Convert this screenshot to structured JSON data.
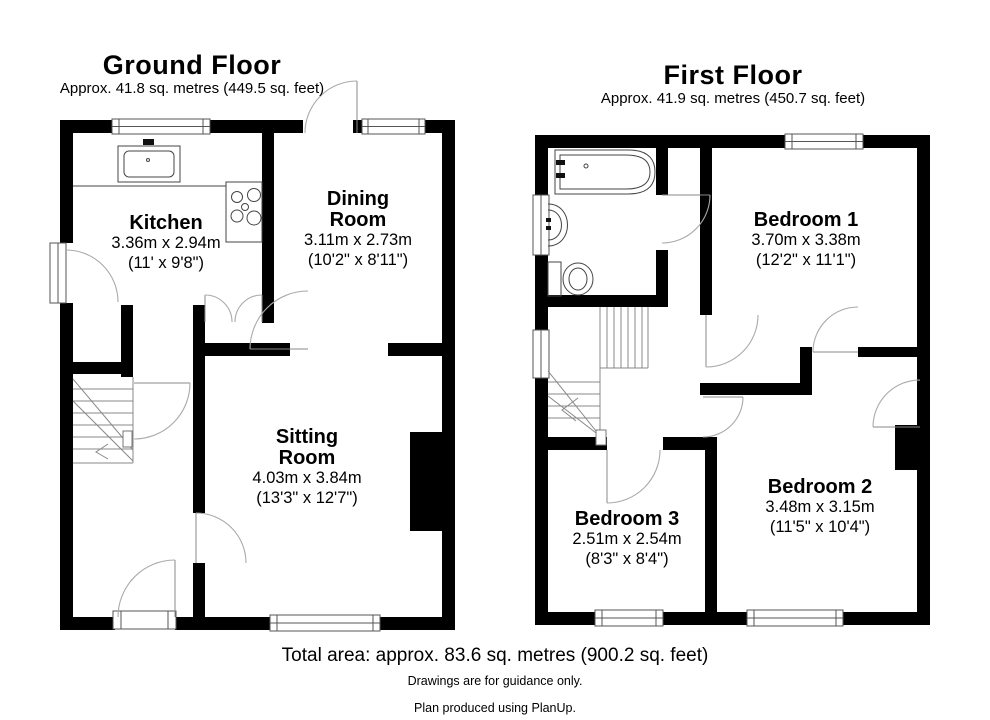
{
  "ground_floor": {
    "title": "Ground Floor",
    "area": "Approx. 41.8 sq. metres (449.5 sq. feet)",
    "rooms": [
      {
        "name": "Kitchen",
        "metric": "3.36m x 2.94m",
        "imperial": "(11' x 9'8\")"
      },
      {
        "name": "Dining Room",
        "metric": "3.11m x 2.73m",
        "imperial": "(10'2\" x 8'11\")"
      },
      {
        "name": "Sitting Room",
        "metric": "4.03m x 3.84m",
        "imperial": "(13'3\" x 12'7\")"
      }
    ]
  },
  "first_floor": {
    "title": "First Floor",
    "area": "Approx. 41.9 sq. metres (450.7 sq. feet)",
    "rooms": [
      {
        "name": "Bedroom 1",
        "metric": "3.70m x 3.38m",
        "imperial": "(12'2\" x 11'1\")"
      },
      {
        "name": "Bedroom 2",
        "metric": "3.48m x 3.15m",
        "imperial": "(11'5\" x 10'4\")"
      },
      {
        "name": "Bedroom 3",
        "metric": "2.51m x 2.54m",
        "imperial": "(8'3\" x 8'4\")"
      }
    ]
  },
  "footer": {
    "total_area": "Total area: approx. 83.6 sq. metres (900.2 sq. feet)",
    "disclaimer": "Drawings are for guidance only.",
    "credit": "Plan produced using PlanUp."
  },
  "colors": {
    "wall": "#000000",
    "door_arc": "#aaaaaa",
    "text": "#000000",
    "background": "#ffffff"
  }
}
